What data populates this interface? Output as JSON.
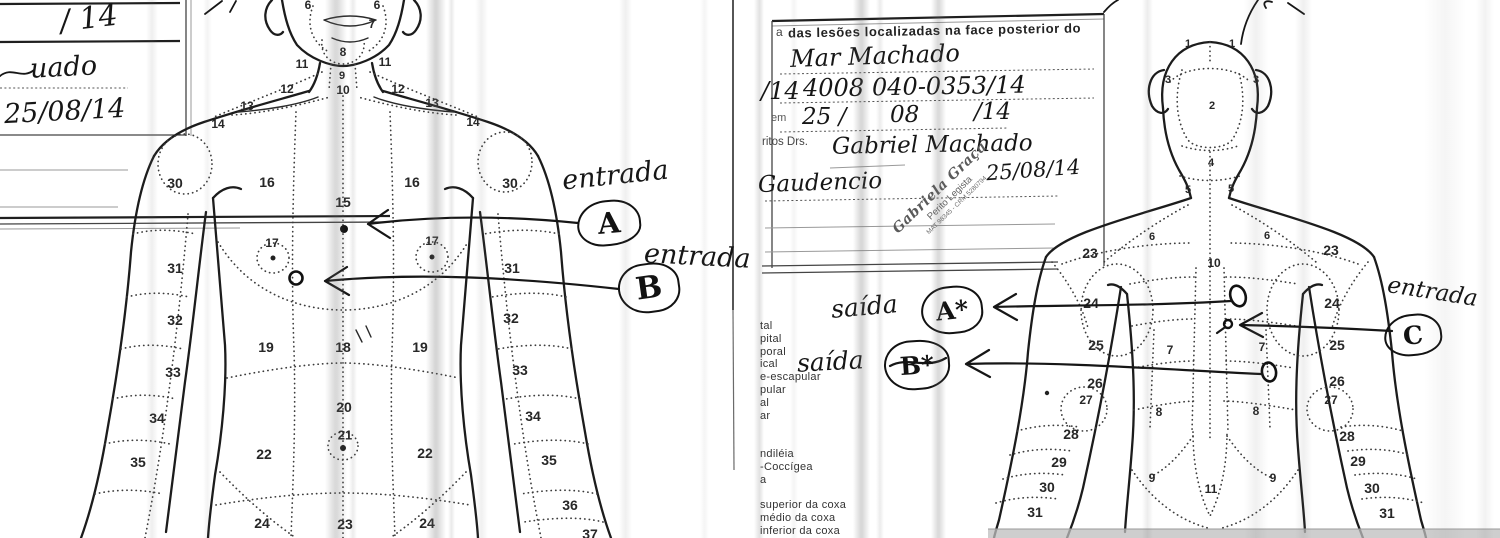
{
  "left_page": {
    "form": {
      "hw_top": "/ 14",
      "hw_name": "uado",
      "hw_date": "25/08/14"
    },
    "annotations": [
      {
        "word": "entrada",
        "letter": "A"
      },
      {
        "word": "entrada",
        "letter": "B"
      }
    ],
    "figure_numbers": [
      [
        "6",
        308,
        5,
        12
      ],
      [
        "6",
        377,
        5,
        12
      ],
      [
        "7",
        372,
        24,
        12
      ],
      [
        "8",
        343,
        52,
        12
      ],
      [
        "11",
        302,
        64,
        12
      ],
      [
        "11",
        385,
        62,
        12
      ],
      [
        "9",
        342,
        76,
        11
      ],
      [
        "12",
        287,
        89,
        12
      ],
      [
        "10",
        343,
        90,
        12
      ],
      [
        "12",
        398,
        89,
        12
      ],
      [
        "13",
        247,
        106,
        12
      ],
      [
        "13",
        432,
        103,
        12
      ],
      [
        "14",
        218,
        124,
        12
      ],
      [
        "14",
        473,
        122,
        12
      ],
      [
        "30",
        175,
        183
      ],
      [
        "16",
        267,
        182
      ],
      [
        "15",
        343,
        202
      ],
      [
        "16",
        412,
        182
      ],
      [
        "30",
        510,
        183
      ],
      [
        "17",
        272,
        243,
        12
      ],
      [
        "17",
        432,
        241,
        12
      ],
      [
        "31",
        175,
        268
      ],
      [
        "31",
        512,
        268
      ],
      [
        "32",
        175,
        320
      ],
      [
        "32",
        511,
        318
      ],
      [
        "19",
        266,
        347
      ],
      [
        "18",
        343,
        347
      ],
      [
        "19",
        420,
        347
      ],
      [
        "33",
        173,
        372
      ],
      [
        "33",
        520,
        370
      ],
      [
        "20",
        344,
        407
      ],
      [
        "34",
        157,
        418
      ],
      [
        "34",
        533,
        416
      ],
      [
        "21",
        345,
        435,
        13
      ],
      [
        "22",
        264,
        454
      ],
      [
        "22",
        425,
        453
      ],
      [
        "35",
        138,
        462
      ],
      [
        "35",
        549,
        460
      ],
      [
        "36",
        570,
        505
      ],
      [
        "24",
        262,
        523
      ],
      [
        "23",
        345,
        524
      ],
      [
        "24",
        427,
        523
      ],
      [
        "37",
        590,
        534
      ]
    ]
  },
  "right_page": {
    "form": {
      "header_prefix": "a",
      "header": "das lesões localizadas na face posterior do",
      "line1": "Mar Machado",
      "line2a": "/14",
      "line2b": "4008",
      "line2c": "040-0353/14",
      "line3_label": "em",
      "line3a": "25 /",
      "line3b": "08",
      "line3c": "/14",
      "line4_label": "ritos Drs.",
      "line4": "Gabriel Machado",
      "line5": "Gaudencio",
      "date": "25/08/14",
      "stamp": {
        "name": "Gabriela Graça",
        "title": "Perito Legista",
        "reg": "MAT 98345 - CRM 5280794"
      }
    },
    "legend_lines": [
      "tal",
      "pital",
      "poral",
      "ical",
      "e-escapular",
      "pular",
      "al",
      "ar",
      "",
      "",
      "ndiléia",
      "-Coccígea",
      "a",
      "",
      "superior da coxa",
      "médio da coxa",
      "inferior da coxa"
    ],
    "annotations": [
      {
        "word": "saída",
        "letter": "A*"
      },
      {
        "word": "saída",
        "letter": "B*"
      },
      {
        "word": "entrada",
        "letter": "C"
      }
    ],
    "figure_numbers": [
      [
        "1",
        1188,
        44,
        11
      ],
      [
        "1",
        1232,
        44,
        11
      ],
      [
        "3",
        1168,
        80,
        11
      ],
      [
        "3",
        1256,
        80,
        11
      ],
      [
        "2",
        1212,
        106,
        11
      ],
      [
        "4",
        1211,
        163,
        11
      ],
      [
        "5",
        1188,
        190,
        11
      ],
      [
        "5",
        1231,
        189,
        11
      ],
      [
        "6",
        1152,
        237,
        11
      ],
      [
        "6",
        1267,
        236,
        11
      ],
      [
        "23",
        1090,
        253
      ],
      [
        "23",
        1331,
        250
      ],
      [
        "10",
        1214,
        263,
        12
      ],
      [
        "24",
        1091,
        303
      ],
      [
        "24",
        1332,
        303
      ],
      [
        "25",
        1096,
        345
      ],
      [
        "7",
        1170,
        350,
        12
      ],
      [
        "7",
        1262,
        347,
        12
      ],
      [
        "25",
        1337,
        345
      ],
      [
        "26",
        1095,
        383
      ],
      [
        "26",
        1337,
        381
      ],
      [
        "27",
        1086,
        400,
        12
      ],
      [
        "27",
        1331,
        400,
        12
      ],
      [
        "8",
        1159,
        412,
        12
      ],
      [
        "8",
        1256,
        411,
        12
      ],
      [
        "28",
        1071,
        434
      ],
      [
        "28",
        1347,
        436
      ],
      [
        "29",
        1059,
        462
      ],
      [
        "29",
        1358,
        461
      ],
      [
        "30",
        1047,
        487
      ],
      [
        "30",
        1372,
        488
      ],
      [
        "31",
        1035,
        512
      ],
      [
        "31",
        1387,
        513
      ],
      [
        "9",
        1152,
        478,
        12
      ],
      [
        "9",
        1273,
        478,
        12
      ],
      [
        "11",
        1211,
        489,
        12
      ]
    ]
  }
}
